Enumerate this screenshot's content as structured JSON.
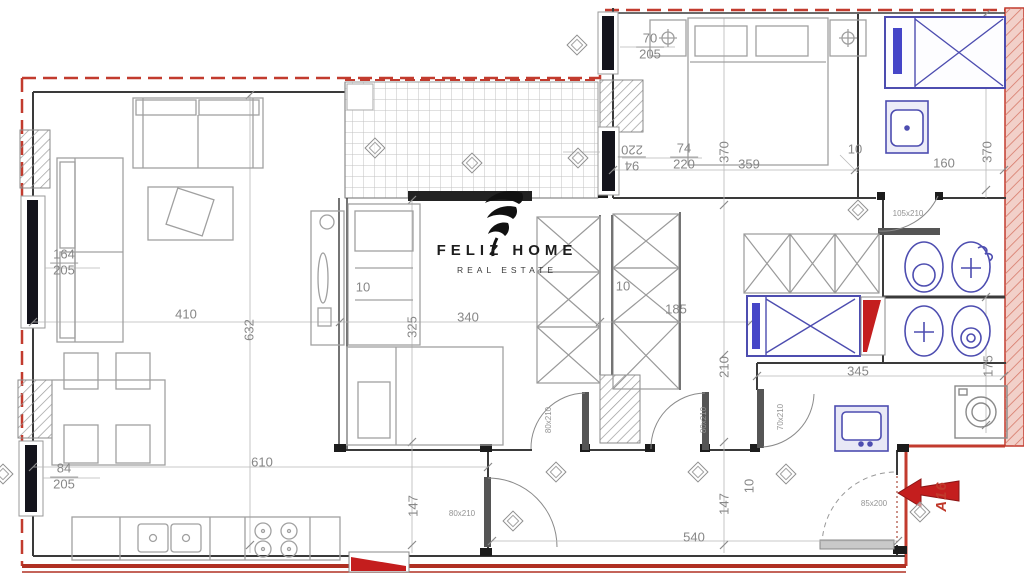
{
  "brand": {
    "name": "FELIZ HOME",
    "tagline": "REAL ESTATE"
  },
  "unit": {
    "label": "A16"
  },
  "colors": {
    "boundary_red": "#c23b2e",
    "wall_dark": "#3a3a3a",
    "furniture_gray": "#a0a0a0",
    "fixture_blue": "#4d4db0",
    "accent_red": "#c41e1e",
    "dim_text": "#878787"
  },
  "plan": {
    "dimensions": [
      {
        "top": "70",
        "bottom": "205",
        "x": 650,
        "y": 47
      },
      {
        "top": "94",
        "bottom": "220",
        "x": 632,
        "y": 157,
        "rot": 180
      },
      {
        "top": "74",
        "bottom": "220",
        "x": 684,
        "y": 157
      },
      {
        "text": "370",
        "x": 724,
        "y": 152,
        "rot": -90
      },
      {
        "text": "359",
        "x": 749,
        "y": 164
      },
      {
        "text": "10",
        "x": 855,
        "y": 149
      },
      {
        "text": "160",
        "x": 944,
        "y": 163
      },
      {
        "text": "370",
        "x": 987,
        "y": 152,
        "rot": -90
      },
      {
        "top": "164",
        "bottom": "205",
        "x": 64,
        "y": 263
      },
      {
        "top": "84",
        "bottom": "205",
        "x": 64,
        "y": 477
      },
      {
        "text": "410",
        "x": 186,
        "y": 314
      },
      {
        "text": "632",
        "x": 249,
        "y": 330,
        "rot": -90
      },
      {
        "text": "10",
        "x": 363,
        "y": 287
      },
      {
        "text": "325",
        "x": 412,
        "y": 327,
        "rot": -90
      },
      {
        "text": "340",
        "x": 468,
        "y": 317
      },
      {
        "text": "10",
        "x": 623,
        "y": 286
      },
      {
        "text": "185",
        "x": 676,
        "y": 309
      },
      {
        "text": "210",
        "x": 724,
        "y": 367,
        "rot": -90
      },
      {
        "text": "345",
        "x": 858,
        "y": 371
      },
      {
        "text": "175",
        "x": 988,
        "y": 366,
        "rot": -90
      },
      {
        "text": "610",
        "x": 262,
        "y": 462
      },
      {
        "text": "540",
        "x": 694,
        "y": 537
      },
      {
        "text": "147",
        "x": 413,
        "y": 506,
        "rot": -90
      },
      {
        "text": "147",
        "x": 724,
        "y": 504,
        "rot": -90
      },
      {
        "text": "10",
        "x": 749,
        "y": 486,
        "rot": -90
      },
      {
        "text": "80x210",
        "x": 462,
        "y": 514,
        "small": true
      },
      {
        "text": "80x210",
        "x": 549,
        "y": 420,
        "rot": -90,
        "small": true
      },
      {
        "text": "80x210",
        "x": 704,
        "y": 420,
        "rot": -90,
        "small": true
      },
      {
        "text": "70x210",
        "x": 781,
        "y": 417,
        "rot": -90,
        "small": true
      },
      {
        "text": "105x210",
        "x": 908,
        "y": 214,
        "small": true
      },
      {
        "text": "85x200",
        "x": 874,
        "y": 504,
        "small": true
      }
    ],
    "area_markers": [
      {
        "x": 577,
        "y": 45
      },
      {
        "x": 375,
        "y": 148
      },
      {
        "x": 472,
        "y": 163
      },
      {
        "x": 578,
        "y": 158
      },
      {
        "x": 858,
        "y": 210
      },
      {
        "x": 513,
        "y": 521
      },
      {
        "x": 556,
        "y": 472
      },
      {
        "x": 698,
        "y": 472
      },
      {
        "x": 786,
        "y": 474
      },
      {
        "x": 920,
        "y": 512
      },
      {
        "x": 3,
        "y": 474
      }
    ]
  }
}
